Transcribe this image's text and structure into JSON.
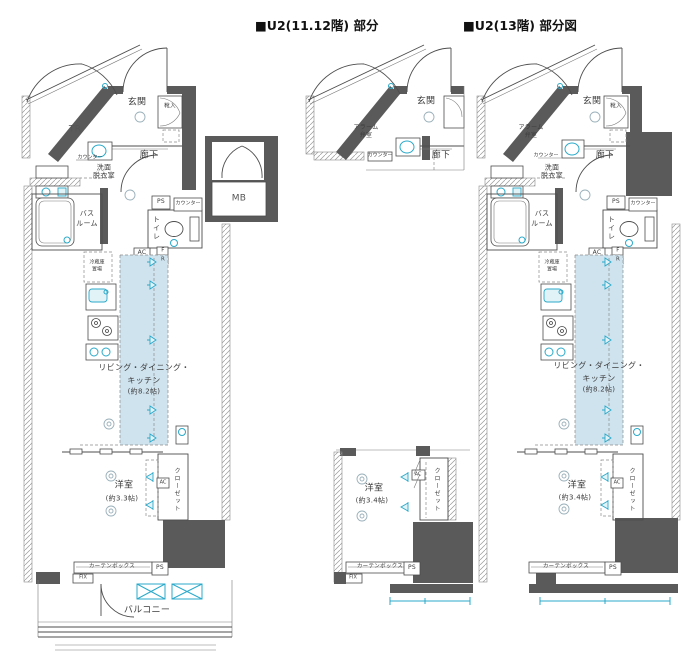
{
  "titles": {
    "mid": "■U2(11.12階) 部分",
    "right": "■U2(13階) 部分図"
  },
  "colors": {
    "wall": "#5a5a5a",
    "accent_cyan": "#2aa9c9",
    "ldk_fill": "#cfe3ef",
    "text": "#3c3c3c"
  },
  "plan_left": {
    "labels": {
      "tr": "TR",
      "genkan": "玄関",
      "kutsuire": "靴入",
      "mb": "MB",
      "rouka": "廊下",
      "counter_a": "カウンター",
      "senmen1": "洗面",
      "senmen2": "脱衣室",
      "bath1": "バス",
      "bath2": "ルーム",
      "toilet": "トイレ",
      "ps_a": "PS",
      "counter_b": "カウンター",
      "ac": "AC",
      "f": "F",
      "r": "R",
      "fridge1": "冷蔵庫",
      "fridge2": "置場",
      "ldk1": "リビング・ダイニング・",
      "ldk2": "キッチン",
      "ldk3": "(約8.2帖)",
      "youshitsu1": "洋室",
      "youshitsu2": "(約3.3帖)",
      "ac_unit": "AC",
      "closet": "クローゼット",
      "curtain": "カーテンボックス",
      "ps_b": "PS",
      "fix": "FIX",
      "balcony": "バルコニー"
    }
  },
  "plan_mid": {
    "labels": {
      "alarm1": "アラーム",
      "alarm2": "弁室",
      "genkan": "玄関",
      "rouka": "廊下",
      "counter": "カウンター",
      "youshitsu1": "洋室",
      "youshitsu2": "(約3.4帖)",
      "ac_unit": "AC",
      "closet": "クローゼット",
      "curtain": "カーテンボックス",
      "ps": "PS",
      "fix": "FIX"
    }
  },
  "plan_right": {
    "labels": {
      "alarm1": "アラーム",
      "alarm2": "弁室",
      "genkan": "玄関",
      "kutsuire": "靴入",
      "rouka": "廊下",
      "counter_a": "カウンター",
      "senmen1": "洗面",
      "senmen2": "脱衣室",
      "bath1": "バス",
      "bath2": "ルーム",
      "toilet": "トイレ",
      "ps_a": "PS",
      "counter_b": "カウンター",
      "ac": "AC",
      "f": "F",
      "r": "R",
      "fridge1": "冷蔵庫",
      "fridge2": "置場",
      "ldk1": "リビング・ダイニング・",
      "ldk2": "キッチン",
      "ldk3": "(約8.2帖)",
      "youshitsu1": "洋室",
      "youshitsu2": "(約3.4帖)",
      "ac_unit": "AC",
      "closet": "クローゼット",
      "curtain": "カーテンボックス",
      "ps_b": "PS"
    }
  }
}
